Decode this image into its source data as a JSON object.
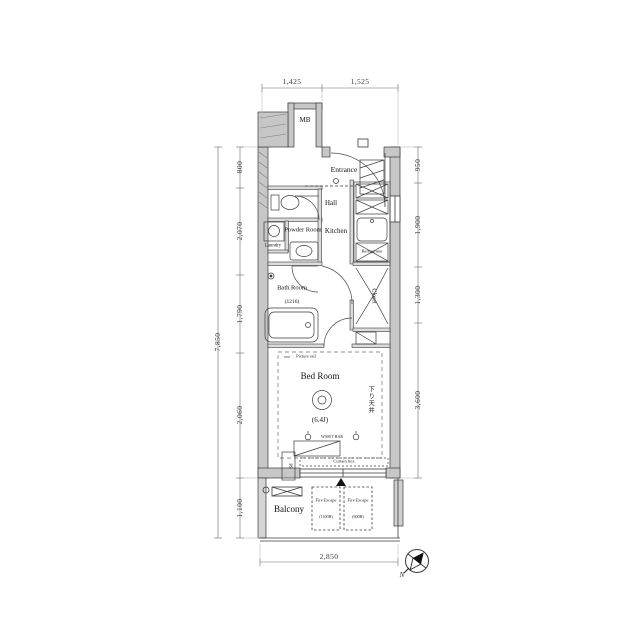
{
  "dimensions": {
    "top": [
      "1,425",
      "1,525"
    ],
    "left_segments": [
      "800",
      "2,070",
      "1,790",
      "2,060",
      "1,100"
    ],
    "left_total": "7,850",
    "right_segments": [
      "950",
      "1,900",
      "1,300",
      "3,600"
    ],
    "bottom": "2,850"
  },
  "rooms": {
    "mb": "MB",
    "entrance": "Entrance",
    "hall": "Hall",
    "kitchen": "Kitchen",
    "powder": "Powder Room",
    "laundry": "Laundry",
    "bath": "Bath Room",
    "bath_size": "(1216)",
    "refrigerator": "Refrigerator",
    "closet": "Closet",
    "bedroom": "Bed Room",
    "bedroom_size": "(6.4J)",
    "balcony": "Balcony",
    "ps": "PS"
  },
  "annotations": {
    "picture_rail": "Picture rail",
    "curtain_box": "Curtain box",
    "lowered_ceiling": "下り天井",
    "hanger_bar": "W900 T.BAR",
    "fire_escape_1": {
      "label": "Fire Escape",
      "sub": "(1100H)"
    },
    "fire_escape_2": {
      "label": "Fire Escape",
      "sub": "(600H)"
    },
    "compass_n": "N"
  },
  "colors": {
    "wall_fill": "#c7c7c7",
    "line": "#3a3a3a",
    "dim_line": "#6b6b6b",
    "background": "#ffffff"
  }
}
